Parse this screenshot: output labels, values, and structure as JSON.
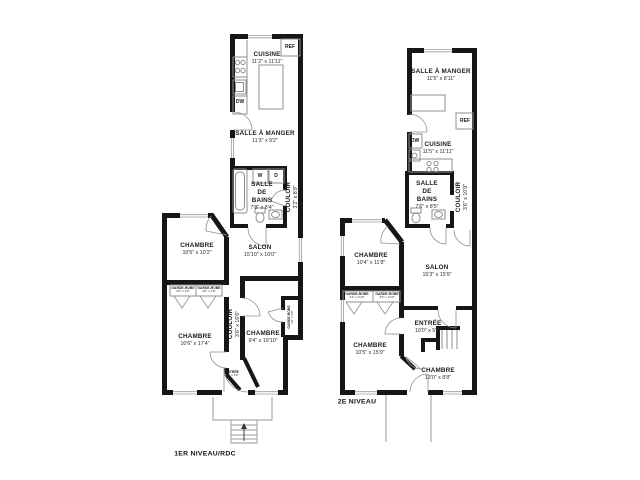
{
  "colors": {
    "wall": "#161616",
    "thin_line": "#8f8f8f",
    "window_line": "#9a9a9a"
  },
  "left_plan": {
    "level_label": "1ER NIVEAU/RDC",
    "rooms": [
      {
        "name": "CUISINE",
        "dims": "11'2\" x 11'11\""
      },
      {
        "name": "SALLE À MANGER",
        "dims": "11'3\" x 9'2\""
      },
      {
        "name": "SALLE DE BAINS",
        "dims": "7'8\" x 8'4\""
      },
      {
        "name": "COULOIR",
        "dims": "3'2\" x 8'9\""
      },
      {
        "name": "CHAMBRE",
        "dims": "10'5\" x 10'2\""
      },
      {
        "name": "SALON",
        "dims": "15'10\" x 10'0\""
      },
      {
        "name": "CHAMBRE",
        "dims": "10'6\" x 17'4\""
      },
      {
        "name": "COULOIR",
        "dims": "3'6\" x 16'6\""
      },
      {
        "name": "CHAMBRE",
        "dims": "9'4\" x 19'10\""
      },
      {
        "name": "GARDE-ROBE",
        "dims": "2'6\" x 4'8\""
      },
      {
        "name": "GARDE-ROBE",
        "dims": "4'0\" x 1'9\""
      },
      {
        "name": "GARDE-ROBE",
        "dims": "4'0\" x 1'9\""
      },
      {
        "name": "ENTRÉE",
        "dims": "4'0\" x 3'6\""
      }
    ],
    "appliances": {
      "ref": "REF",
      "dw": "DW",
      "washer": "W",
      "dryer": "D"
    }
  },
  "right_plan": {
    "level_label": "2E NIVEAU",
    "rooms": [
      {
        "name": "SALLE À MANGER",
        "dims": "11'5\" x 8'11\""
      },
      {
        "name": "CUISINE",
        "dims": "11'5\" x 11'11\""
      },
      {
        "name": "SALLE DE BAINS",
        "dims": "7'6\" x 8'5\""
      },
      {
        "name": "COULOIR",
        "dims": "3'6\" x 10'9\""
      },
      {
        "name": "CHAMBRE",
        "dims": "10'4\" x 11'8\""
      },
      {
        "name": "SALON",
        "dims": "15'3\" x 15'9\""
      },
      {
        "name": "CHAMBRE",
        "dims": "10'5\" x 15'9\""
      },
      {
        "name": "ENTRÉE",
        "dims": "10'0\" x 5'0\""
      },
      {
        "name": "CHAMBRE",
        "dims": "13'0\" x 8'8\""
      },
      {
        "name": "GARDE-ROBE",
        "dims": "4'1\" x 2'10\""
      },
      {
        "name": "GARDE-ROBE",
        "dims": "3'9\" x 2'10\""
      }
    ],
    "appliances": {
      "ref": "REF",
      "dw": "DW"
    }
  }
}
